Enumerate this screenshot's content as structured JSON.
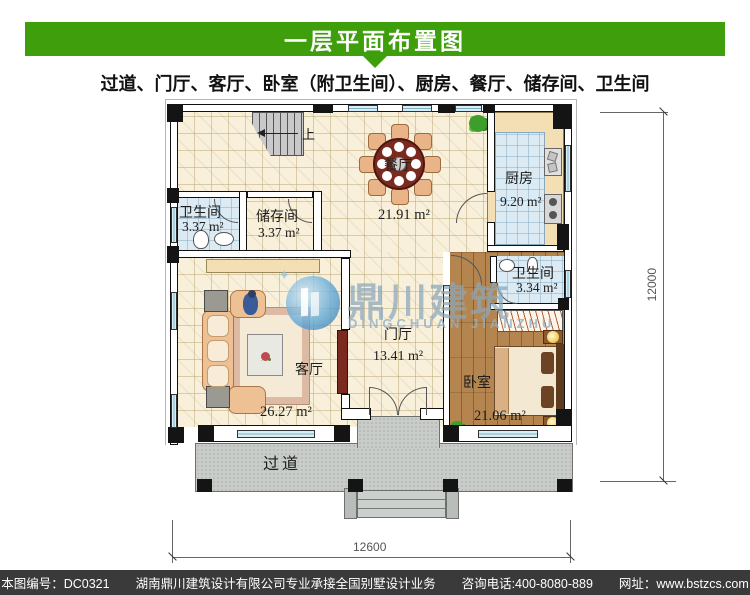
{
  "header": {
    "title": "一层平面布置图"
  },
  "subtitle": "过道、门厅、客厅、卧室（附卫生间）、厨房、餐厅、储存间、卫生间",
  "rooms": {
    "bath1": {
      "name": "卫生间",
      "area": "3.37 m²"
    },
    "storage": {
      "name": "储存间",
      "area": "3.37 m²"
    },
    "dining": {
      "name": "餐厅",
      "area": "21.91 m²"
    },
    "kitchen": {
      "name": "厨房",
      "area": "9.20 m²"
    },
    "bath2": {
      "name": "卫生间",
      "area": "3.34 m²"
    },
    "hall": {
      "name": "门厅",
      "area": "13.41 m²"
    },
    "living": {
      "name": "客厅",
      "area": "26.27 m²"
    },
    "bedroom": {
      "name": "卧室",
      "area": "21.06 m²"
    },
    "corridor": {
      "name": "过道"
    }
  },
  "stairs": {
    "up_label": "上"
  },
  "dimensions": {
    "right": "12000",
    "bottom": "12600"
  },
  "watermark": {
    "cn": "鼎川建筑",
    "en": "DINGCHUAN JIANZHU"
  },
  "footer": {
    "code": "本图编号：DC0321",
    "company": "湖南鼎川建筑设计有限公司专业承接全国别墅设计业务",
    "phone": "咨询电话:400-8080-889",
    "website": "网址：www.bstzcs.com"
  },
  "colors": {
    "header_green": "#3f9e0b",
    "footer_gray": "#3a3a3a",
    "floor_cream": "#f8f0da",
    "tile_blue": "#dcebf3",
    "wood_brown": "#b5854f",
    "porch_gray": "#c9cdc9",
    "counter_beige": "#f4dfb5",
    "table_red": "#7b2a20",
    "sofa_tan": "#eec194",
    "watermark_blue": "#8aa8bc"
  }
}
